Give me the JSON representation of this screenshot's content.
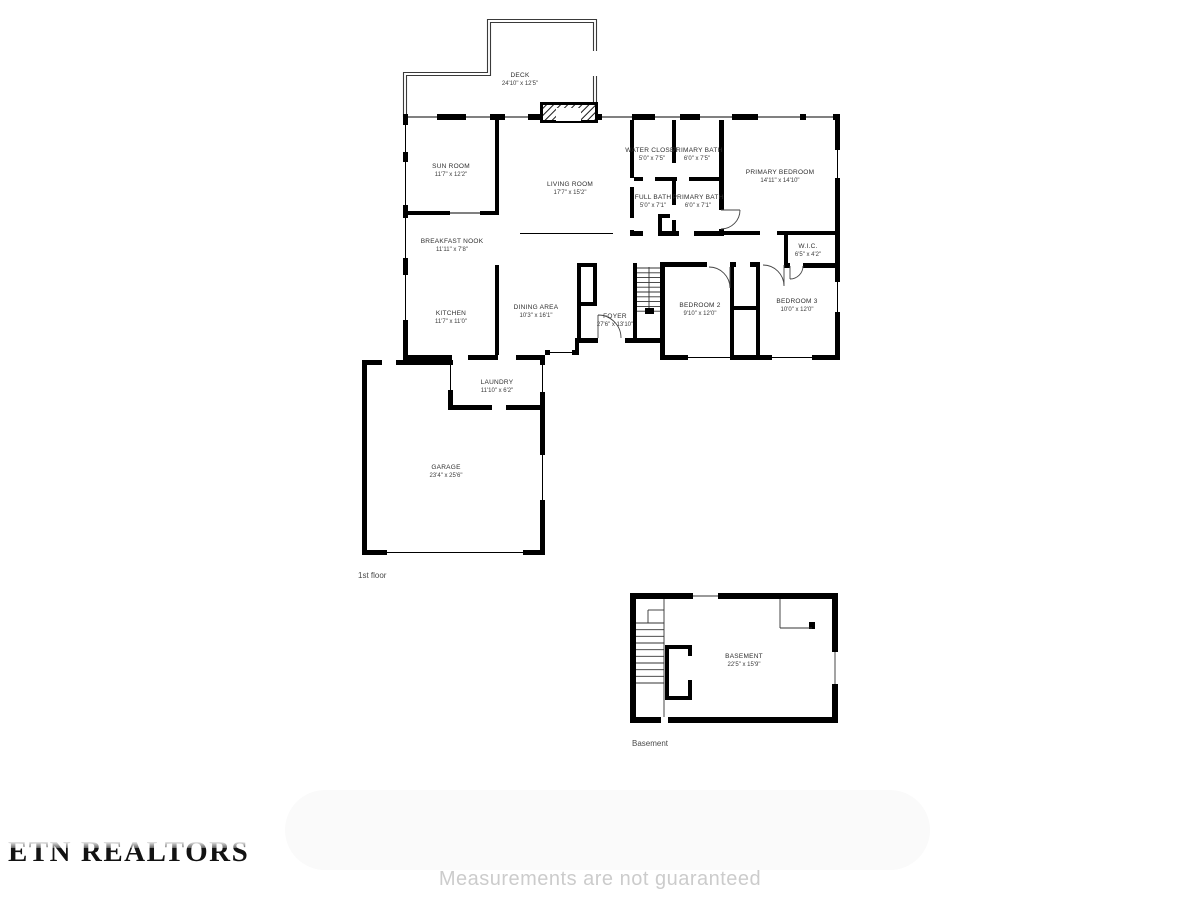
{
  "branding": {
    "logo_text": "ETN REALTORS"
  },
  "disclaimer": "Measurements are not guaranteed",
  "floors": [
    {
      "caption": "1st floor",
      "rooms": [
        {
          "name": "DECK",
          "dims": "24'10\" x 12'5\""
        },
        {
          "name": "SUN ROOM",
          "dims": "11'7\" x 12'2\""
        },
        {
          "name": "LIVING ROOM",
          "dims": "17'7\" x 15'2\""
        },
        {
          "name": "WATER CLOSET",
          "dims": "5'0\" x 7'5\""
        },
        {
          "name": "PRIMARY BATH",
          "dims": "6'0\" x 7'5\""
        },
        {
          "name": "PRIMARY BEDROOM",
          "dims": "14'11\" x 14'10\""
        },
        {
          "name": "FULL BATH",
          "dims": "5'0\" x 7'1\""
        },
        {
          "name": "PRIMARY BATH",
          "dims": "6'0\" x 7'1\""
        },
        {
          "name": "BREAKFAST NOOK",
          "dims": "11'11\" x 7'8\""
        },
        {
          "name": "W.I.C.",
          "dims": "6'5\" x 4'2\""
        },
        {
          "name": "KITCHEN",
          "dims": "11'7\" x 11'0\""
        },
        {
          "name": "DINING AREA",
          "dims": "10'3\" x 16'1\""
        },
        {
          "name": "FOYER",
          "dims": "27'6\" x 13'10\""
        },
        {
          "name": "BEDROOM 2",
          "dims": "9'10\" x 12'0\""
        },
        {
          "name": "BEDROOM 3",
          "dims": "10'0\" x 12'0\""
        },
        {
          "name": "LAUNDRY",
          "dims": "11'10\" x 6'2\""
        },
        {
          "name": "GARAGE",
          "dims": "23'4\" x 25'6\""
        }
      ]
    },
    {
      "caption": "Basement",
      "rooms": [
        {
          "name": "BASEMENT",
          "dims": "22'5\" x 15'9\""
        }
      ]
    }
  ]
}
